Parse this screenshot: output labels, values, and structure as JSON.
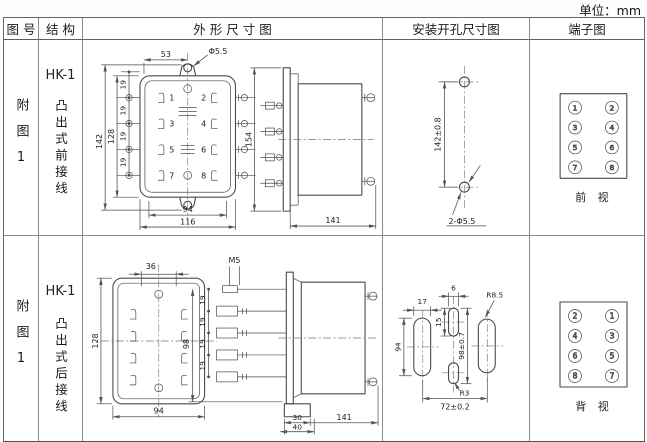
{
  "unit_label": "单位：mm",
  "table": {
    "headers": {
      "fig_no": "图 号",
      "structure": "结 构",
      "outline": "外 形 尺 寸 图",
      "mounting": "安装开孔尺寸图",
      "terminals": "端子图"
    }
  },
  "rows": [
    {
      "fig_no": "附图1",
      "model": "HK-1",
      "structure_desc": "凸出式前接线",
      "outline": {
        "terminals": [
          "1",
          "2",
          "3",
          "4",
          "5",
          "6",
          "7",
          "8"
        ],
        "dims": {
          "top_offset": "53",
          "hole_dia": "Φ5.5",
          "height_overall": "142",
          "height_body": "128",
          "pitch": "19",
          "width_inner": "94",
          "width_body": "116",
          "side_height": "154",
          "side_depth": "141"
        }
      },
      "mounting": {
        "hole_span": "142±0.8",
        "holes_label": "2-Φ5.5"
      },
      "terminal_view": {
        "left": [
          "1",
          "3",
          "5",
          "7"
        ],
        "right": [
          "2",
          "4",
          "6",
          "8"
        ],
        "caption": "前 视"
      }
    },
    {
      "fig_no": "附图1",
      "model": "HK-1",
      "structure_desc": "凸出式后接线",
      "outline": {
        "dims": {
          "top_offset": "36",
          "height_body": "128",
          "width_body": "94",
          "thread": "M5",
          "stud_span": "98",
          "pitch": "19",
          "tab_inner": "30",
          "tab_outer": "40",
          "side_depth": "141"
        }
      },
      "mounting": {
        "slot_width": "17",
        "slot_height": "94",
        "mid_slot_width": "6",
        "mid_slot_height": "15",
        "mid_span": "98±0.7",
        "radius_outer": "R8.5",
        "radius_mid": "R3",
        "slot_span": "72±0.2"
      },
      "terminal_view": {
        "left": [
          "2",
          "4",
          "6",
          "8"
        ],
        "right": [
          "1",
          "3",
          "5",
          "7"
        ],
        "caption": "背 视"
      }
    }
  ]
}
